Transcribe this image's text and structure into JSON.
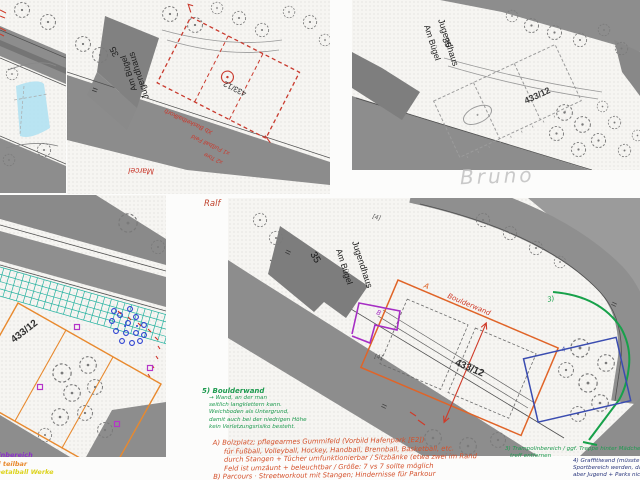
{
  "colors": {
    "print_red": "#c93a2e",
    "note_red": "#d4502a",
    "green": "#1d9a4f",
    "note_blue": "#28357c",
    "mark_blue": "#3a4cb0",
    "scribble_blue": "#2a3fd0",
    "teal": "#25b2a0",
    "orange": "#e8892e",
    "purple": "#a62ec4",
    "yellow": "#ddd31d",
    "pool_cyan": "#aee0f2",
    "pencil": "#c9c9c9",
    "road_gray": "#8d8d8d"
  },
  "map": {
    "parcel": "433/12",
    "building": "Jugendhaus",
    "street": "Am Bügel",
    "house_no": "35",
    "equals": "="
  },
  "names": {
    "ralf": "Ralf",
    "marcel": "Marcel",
    "bruno": "Bruno"
  },
  "marcel_plan": {
    "basketball": "Xb Basketballkorb",
    "fussball": "x1 Fußball Feld",
    "tore": "x2 Tore"
  },
  "final_plan": {
    "label_a": "A",
    "label_b": "B",
    "label_3": "3)",
    "label_4": "4",
    "mark_4a": "[4]",
    "mark_4b": "[4]",
    "boulderwand": "Boulderwand"
  },
  "notes": {
    "n5_title": "5) Boulderwand",
    "n5_lines": [
      "→ Wand, an der man",
      "seitlich langklettern kann.",
      "Weichboden als Untergrund,",
      "damit auch bei der niedrigen Höhe",
      "kein Verletzungsrisiko besteht."
    ],
    "a_lines": [
      "A) Bolzplatz; pflegearmes Gummifeld (Vorbild Hafenpark [E2])",
      "für Fußball, Volleyball, Hockey, Handball, Brennball, Basketball, etc.",
      "durch Stangen + Tücher umfunktionierbar / Sitzbänke (etwa zwei im Rand",
      "Feld ist umzäunt + beleuchtbar / Größe: 7 vs 7 sollte möglich",
      "B) Parcours · Streetworkout mit Stangen; Hindernisse für Parkour"
    ],
    "n3_lines": [
      "3) Trampolinbereich / ggf. Treppe hinter Mädchen-",
      "treff entfernen"
    ],
    "n4_lines": [
      "4) Graffitiwand (müsste einzeln abgetrennt vom",
      "Sportbereich werden, damit immer zugänglich,",
      "aber Jugend + Parks nicht über den Sportbereich)"
    ],
    "frag_purple": "llinbereich",
    "frag_orange": "el teilbar",
    "frag_yellow": "metalball Werke"
  }
}
